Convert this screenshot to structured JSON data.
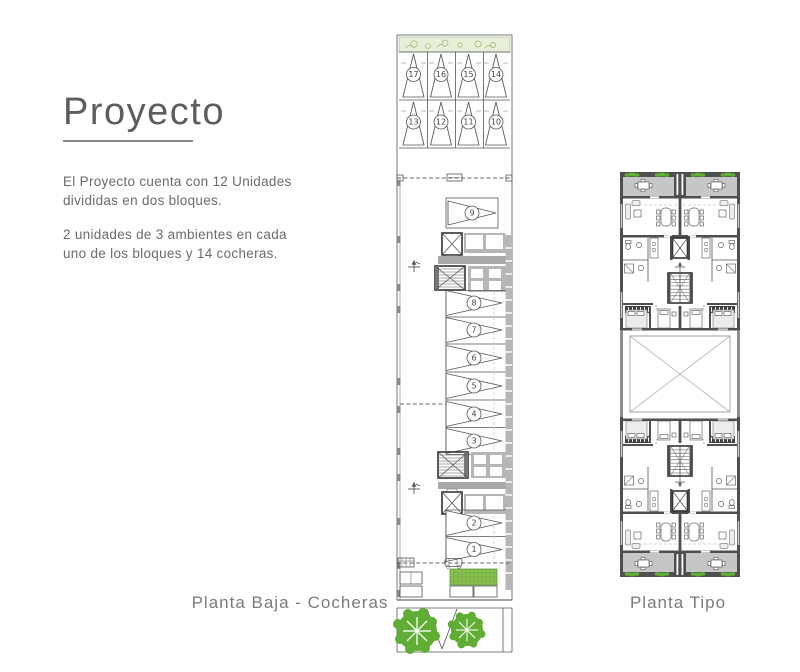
{
  "intro": {
    "title": "Proyecto",
    "p1": [
      "El Proyecto cuenta con 12 Unidades",
      "divididas en dos bloques."
    ],
    "p2": [
      "2 unidades de 3 ambientes en cada",
      "uno de los bloques y 14 cocheras."
    ]
  },
  "plans": {
    "planta_baja_label": "Planta Baja - Cocheras",
    "planta_tipo_label": "Planta Tipo"
  },
  "planta_baja": {
    "parking_top_row": [
      "17",
      "16",
      "15",
      "14"
    ],
    "parking_second_row": [
      "13",
      "12",
      "11",
      "10"
    ],
    "parking_side_column": [
      "9",
      "8",
      "7",
      "6",
      "5",
      "4",
      "3",
      "2",
      "1"
    ]
  },
  "colors": {
    "tree_green": "#5fae33",
    "garden_green": "#8dc052",
    "planting_strip_green": "#e8efd9",
    "wall_gray": "#4f4f4f",
    "band_gray": "#b6b6b6",
    "text_gray": "#6e6e6e"
  }
}
